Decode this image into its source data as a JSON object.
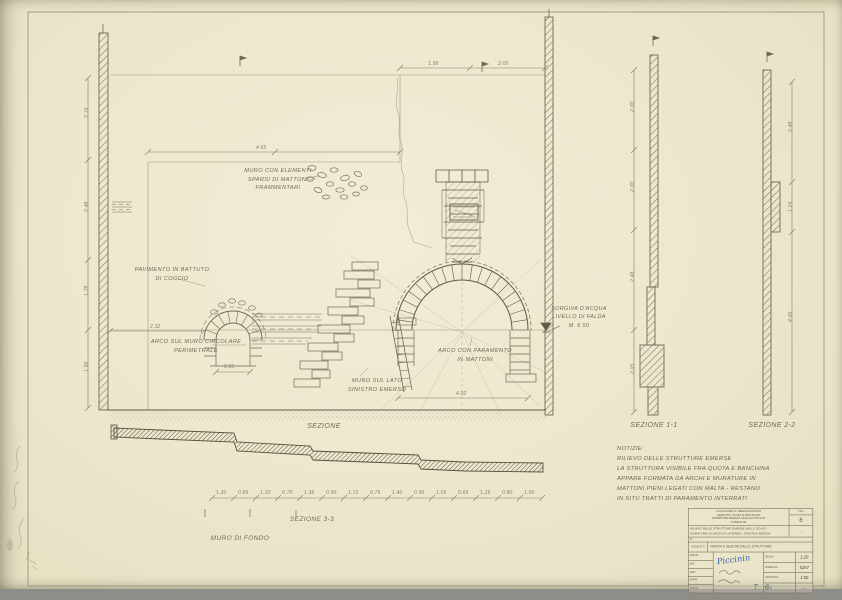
{
  "colors": {
    "paper": "#ece7cc",
    "line": "#6f6b58",
    "hatch": "#7b7663",
    "ink_blue": "#3d66ad",
    "scan_bg": "#8e8d87"
  },
  "annotations": [
    {
      "name": "label-scattered-masonry",
      "x": 238,
      "y": 167,
      "w": 80,
      "size": 5.6,
      "lines": [
        "MURO CON ELEMENTI",
        "SPARSI DI MATTONI",
        "FRAMMENTARI"
      ]
    },
    {
      "name": "label-floor",
      "x": 126,
      "y": 266,
      "w": 92,
      "size": 5.6,
      "lines": [
        "PAVIMENTO IN BATTUTO",
        "DI COCCIO"
      ]
    },
    {
      "name": "label-small-arch",
      "x": 144,
      "y": 338,
      "w": 104,
      "size": 5.6,
      "lines": [
        "ARCO SUL MURO CIRCOLARE",
        "PERIMETRALE"
      ]
    },
    {
      "name": "label-center-wall",
      "x": 330,
      "y": 377,
      "w": 94,
      "size": 5.6,
      "lines": [
        "MURO SUL LATO",
        "SINISTRO EMERSO"
      ]
    },
    {
      "name": "label-main-arch",
      "x": 424,
      "y": 347,
      "w": 102,
      "size": 5.6,
      "lines": [
        "ARCO CON PARAMENTO",
        "IN MATTONI"
      ]
    },
    {
      "name": "label-water-level",
      "x": 546,
      "y": 305,
      "w": 66,
      "size": 5.4,
      "lines": [
        "SORGIVA D'ACQUA",
        "LIVELLO DI FALDA",
        "M. 6.50"
      ]
    },
    {
      "name": "title-sezione-center",
      "x": 288,
      "y": 422,
      "w": 72,
      "size": 7,
      "lines": [
        "SEZIONE"
      ]
    },
    {
      "name": "title-sezione-bb",
      "x": 274,
      "y": 515,
      "w": 76,
      "size": 6.5,
      "lines": [
        "SEZIONE 3-3"
      ]
    },
    {
      "name": "label-muro-fondo",
      "x": 202,
      "y": 534,
      "w": 76,
      "size": 6.5,
      "lines": [
        "MURO DI FONDO"
      ]
    },
    {
      "name": "title-sezione-aa",
      "x": 612,
      "y": 421,
      "w": 84,
      "size": 7,
      "lines": [
        "SEZIONE 1-1"
      ]
    },
    {
      "name": "title-sezione-cc",
      "x": 730,
      "y": 421,
      "w": 84,
      "size": 7,
      "lines": [
        "SEZIONE 2-2"
      ]
    }
  ],
  "notes": {
    "lines": [
      "NOTIZIE:",
      "RILIEVO DELLE STRUTTURE EMERSE",
      "LA STRUTTURA VISIBILE FRA QUOTA E BANCHINA",
      "APPARE FORMATA DA ARCHI E MURATURE IN",
      "MATTONI PIENI LEGATI CON MALTA - RESTANO",
      "IN SITU TRATTI DI PARAMENTO INTERRATI"
    ]
  },
  "dimensions": [
    {
      "x": 428,
      "y": 61,
      "t": "1.95"
    },
    {
      "x": 498,
      "y": 61,
      "t": "2.05"
    },
    {
      "x": 256,
      "y": 145,
      "t": "4.65"
    },
    {
      "x": 150,
      "y": 324,
      "t": "2.32"
    },
    {
      "x": 224,
      "y": 364,
      "t": "0.85"
    },
    {
      "x": 456,
      "y": 391,
      "t": "4.02"
    },
    {
      "x": 84,
      "y": 118,
      "t": "2.10",
      "r": -90
    },
    {
      "x": 84,
      "y": 212,
      "t": "2.48",
      "r": -90
    },
    {
      "x": 84,
      "y": 296,
      "t": "1.78",
      "r": -90
    },
    {
      "x": 84,
      "y": 372,
      "t": "1.95",
      "r": -90
    },
    {
      "x": 630,
      "y": 112,
      "t": "2.00",
      "r": -90
    },
    {
      "x": 630,
      "y": 192,
      "t": "2.00",
      "r": -90
    },
    {
      "x": 630,
      "y": 282,
      "t": "2.48",
      "r": -90
    },
    {
      "x": 630,
      "y": 374,
      "t": "2.05",
      "r": -90
    },
    {
      "x": 788,
      "y": 132,
      "t": "2.48",
      "r": -90
    },
    {
      "x": 788,
      "y": 212,
      "t": "1.24",
      "r": -90
    },
    {
      "x": 788,
      "y": 322,
      "t": "4.45",
      "r": -90
    }
  ],
  "bb_dims": {
    "y": 490,
    "x_start": 212,
    "step": 22,
    "values": [
      "1.20",
      "0.85",
      "1.10",
      "0.70",
      "1.35",
      "0.90",
      "1.15",
      "0.75",
      "1.40",
      "0.95",
      "1.05",
      "0.65",
      "1.25",
      "0.80",
      "1.00"
    ]
  },
  "titleblock": {
    "header_lines": [
      "CASSA PER IL MEZZOGIORNO",
      "SERVIZIO SCAVI E RESTAURI",
      "SOPRINTENDENZA ALLE ANTICHITA'",
      "CAMPANIA"
    ],
    "tav_label": "TAV.",
    "tav_value": "6",
    "desc_lines": [
      "RILIEVO DELLE STRUTTURE EMERSE NELLO SCAVO",
      "MURATURE AD ARCHI IN LATERIZIO - PIANTA E SEZIONI"
    ],
    "desc_side": "—",
    "band_label": "N.",
    "object_label": "OGGETTO",
    "object_text": "PIANTA E SEZIONI DELLE STRUTTURE",
    "sig_labels": [
      "GEOM.",
      "DIS.",
      "VER.",
      "APPR.",
      "VISTO"
    ],
    "signature": "Piccinin",
    "table_rows": [
      {
        "label": "SCALA",
        "value": "1:20"
      },
      {
        "label": "DISEGNO",
        "value": "5257"
      },
      {
        "label": "ARCHIVIO",
        "value": "1:50"
      },
      {
        "label": "DATA",
        "value": "—"
      }
    ]
  },
  "marks": {
    "corner_note": "T. 6."
  }
}
